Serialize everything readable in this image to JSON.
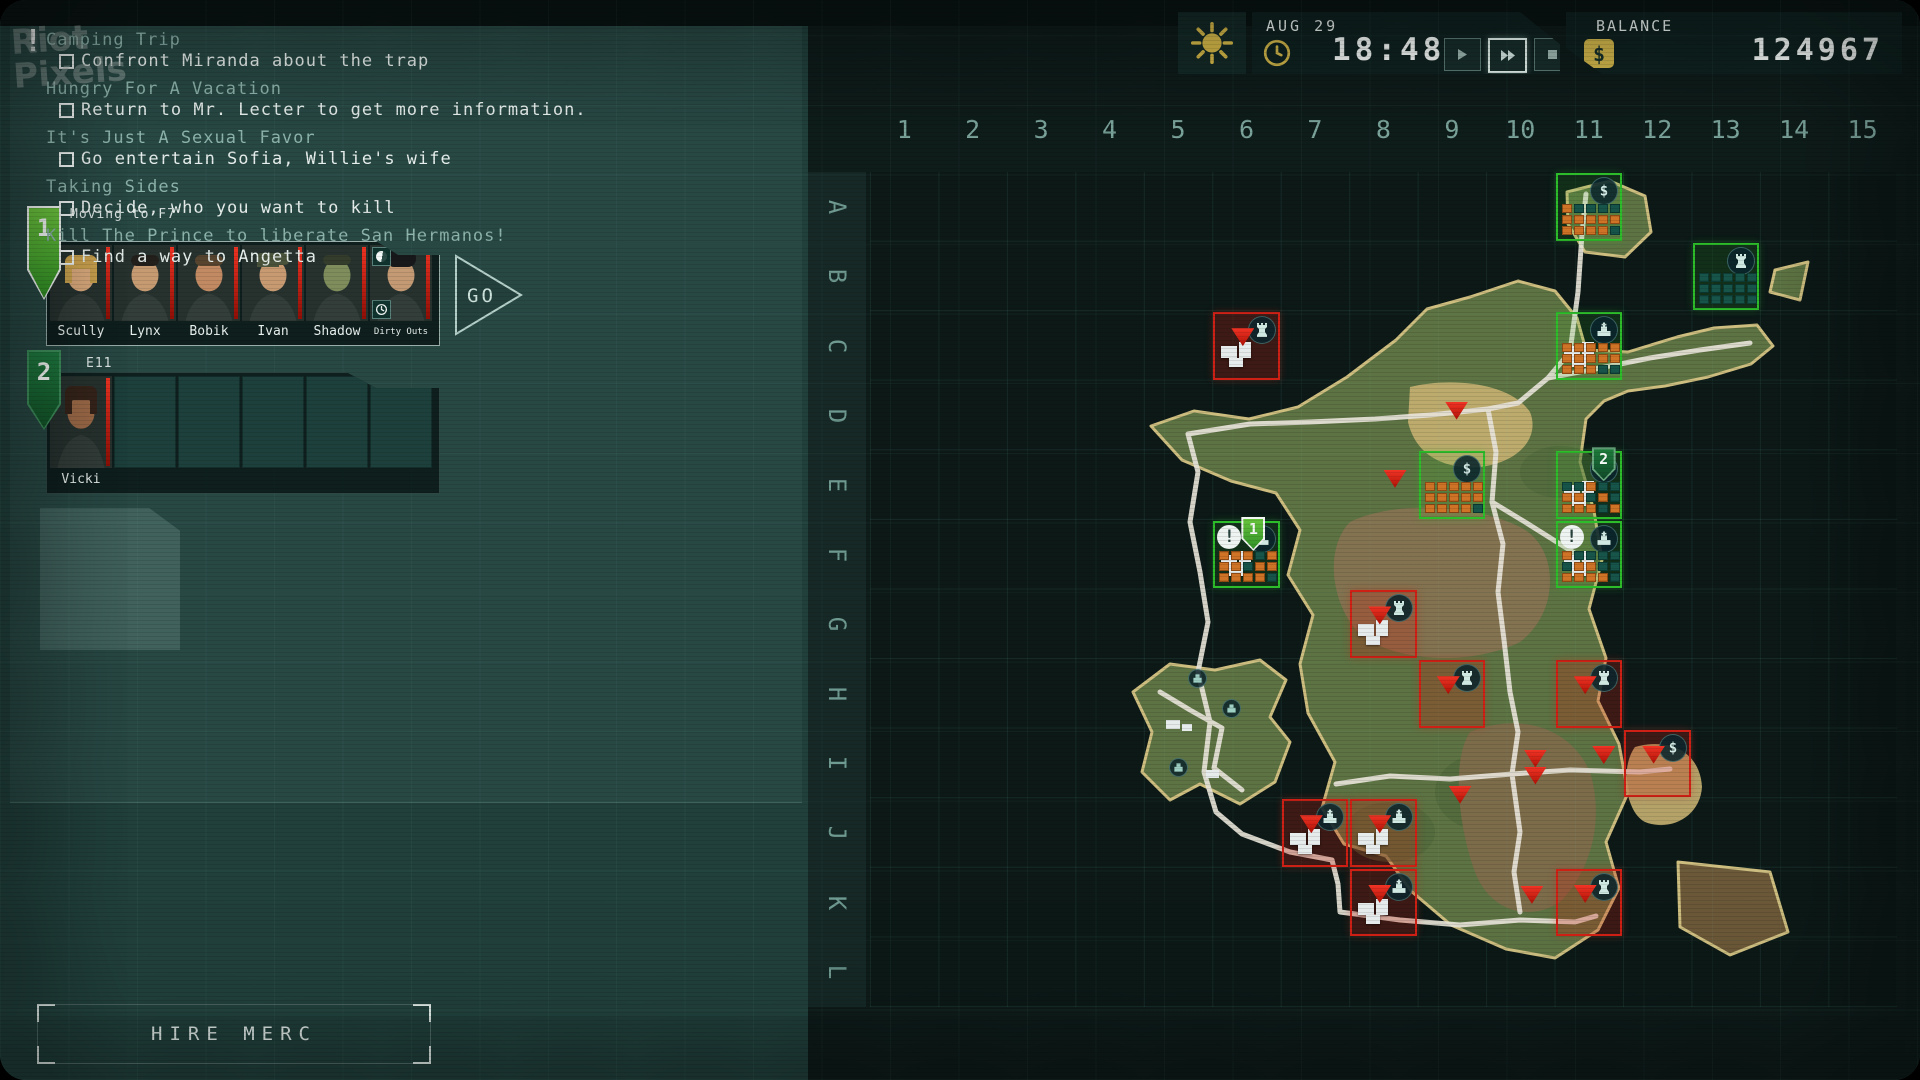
{
  "watermark": {
    "line1": "Riot",
    "line2": "Pixels"
  },
  "topbar": {
    "date": "AUG 29",
    "time": "18:48",
    "balance_label": "BALANCE",
    "balance": "124967",
    "controls": [
      {
        "name": "play",
        "active": false
      },
      {
        "name": "fast-forward",
        "active": true
      },
      {
        "name": "stop",
        "active": false
      }
    ]
  },
  "quests": [
    {
      "title": "Camping Trip",
      "task": "Confront Miranda about the trap",
      "alert": true
    },
    {
      "title": "Hungry For A Vacation",
      "task": "Return to Mr. Lecter to get more information."
    },
    {
      "title": "It's Just A Sexual Favor",
      "task": "Go entertain Sofia, Willie's wife"
    },
    {
      "title": "Taking Sides",
      "task": "Decide, who you want to kill"
    },
    {
      "title": "Kill The Prince to liberate San Hermanos!",
      "task": "Find a way to Angetta"
    }
  ],
  "squads": [
    {
      "number": "1",
      "status": "Moving to F7",
      "go_label": "GO",
      "mercs": [
        {
          "name": "Scully",
          "skin": "#d9a97c",
          "hair": "#c8a04e",
          "style": "long"
        },
        {
          "name": "Lynx",
          "skin": "#c79b72",
          "hair": "#23201c",
          "style": "short"
        },
        {
          "name": "Bobik",
          "skin": "#c28a63",
          "hair": "#57442f",
          "style": "short"
        },
        {
          "name": "Ivan",
          "skin": "#c79a72",
          "hair": "#49523a",
          "style": "cap"
        },
        {
          "name": "Shadow",
          "skin": "#7e8d5b",
          "hair": "#343c2c",
          "style": "camo"
        },
        {
          "name": "Dirty Outs",
          "skin": "#c39a74",
          "hair": "#17181a",
          "style": "beanie",
          "icons": [
            "moon",
            "clock"
          ]
        }
      ]
    },
    {
      "number": "2",
      "status": "E11",
      "mercs": [
        {
          "name": "Vicki",
          "skin": "#9c6a48",
          "hair": "#35241a",
          "style": "long"
        }
      ],
      "empty_slots": 5
    }
  ],
  "hire_label": "HIRE MERC",
  "map": {
    "columns": [
      "1",
      "2",
      "3",
      "4",
      "5",
      "6",
      "7",
      "8",
      "9",
      "10",
      "11",
      "12",
      "13",
      "14",
      "15"
    ],
    "rows": [
      "A",
      "B",
      "C",
      "D",
      "E",
      "F",
      "G",
      "H",
      "I",
      "J",
      "K",
      "L"
    ],
    "sectors": [
      {
        "cell": "A11",
        "side": "player",
        "icon": "dollar",
        "militia": [
          1,
          0,
          0,
          0,
          0,
          1,
          1,
          1,
          1,
          1,
          1,
          1,
          1,
          1,
          0
        ]
      },
      {
        "cell": "B13",
        "side": "player",
        "icon": "tower",
        "militia": [
          0,
          0,
          0,
          0,
          0,
          0,
          0,
          0,
          0,
          0,
          0,
          0,
          0,
          0,
          0
        ]
      },
      {
        "cell": "C11",
        "side": "player",
        "icon": "church",
        "town": true,
        "militia": [
          1,
          1,
          1,
          1,
          1,
          1,
          1,
          1,
          1,
          1,
          1,
          1,
          1,
          0,
          0
        ]
      },
      {
        "cell": "C6",
        "side": "enemy",
        "icon": "tower",
        "town": true,
        "triangle": true
      },
      {
        "cell": "E9",
        "side": "player",
        "icon": "dollar",
        "militia": [
          1,
          1,
          1,
          1,
          1,
          1,
          1,
          1,
          1,
          1,
          1,
          1,
          1,
          1,
          0
        ]
      },
      {
        "cell": "E11",
        "side": "player",
        "icon": "church",
        "town": true,
        "pin": "2",
        "militia": [
          0,
          0,
          1,
          0,
          0,
          1,
          1,
          0,
          1,
          0,
          1,
          1,
          1,
          0,
          1
        ]
      },
      {
        "cell": "F6",
        "side": "player",
        "icon": "church",
        "town": true,
        "pin": "1",
        "alert": true,
        "militia": [
          1,
          1,
          1,
          0,
          1,
          1,
          1,
          0,
          1,
          1,
          1,
          1,
          1,
          1,
          0
        ]
      },
      {
        "cell": "F11",
        "side": "player",
        "icon": "church",
        "town": true,
        "alert": true,
        "militia": [
          1,
          0,
          0,
          0,
          0,
          0,
          1,
          1,
          0,
          0,
          1,
          1,
          1,
          1,
          0
        ]
      },
      {
        "cell": "G8",
        "side": "enemy",
        "icon": "tower",
        "town": true,
        "triangle": true
      },
      {
        "cell": "H9",
        "side": "enemy",
        "icon": "tower",
        "triangle": true
      },
      {
        "cell": "H11",
        "side": "enemy",
        "icon": "tower",
        "triangle": true
      },
      {
        "cell": "I12",
        "side": "enemy",
        "icon": "dollar",
        "triangle": true
      },
      {
        "cell": "J7",
        "side": "enemy",
        "icon": "church",
        "town": true,
        "triangle": true
      },
      {
        "cell": "J8",
        "side": "enemy",
        "icon": "church",
        "town": true,
        "triangle": true
      },
      {
        "cell": "K8",
        "side": "enemy",
        "icon": "church",
        "town": true,
        "triangle": true
      },
      {
        "cell": "K11",
        "side": "enemy",
        "icon": "tower",
        "triangle": true
      }
    ],
    "units": [
      {
        "cell": "D9",
        "fx": 0.4,
        "fy": 0.3,
        "count": 1
      },
      {
        "cell": "E8",
        "fx": 0.5,
        "fy": 0.28,
        "count": 1
      },
      {
        "cell": "I9",
        "fx": 0.45,
        "fy": 0.82,
        "count": 1
      },
      {
        "cell": "I10",
        "fx": 0.55,
        "fy": 0.3,
        "count": 2
      },
      {
        "cell": "I11",
        "fx": 0.55,
        "fy": 0.25,
        "count": 1
      },
      {
        "cell": "K10",
        "fx": 0.5,
        "fy": 0.26,
        "count": 1
      }
    ],
    "deco_icons": [
      {
        "x": 318,
        "y": 497,
        "type": "building"
      },
      {
        "x": 352,
        "y": 527,
        "type": "building"
      },
      {
        "x": 299,
        "y": 586,
        "type": "building"
      }
    ]
  },
  "colors": {
    "player_green": "#2dbd2b",
    "enemy_red": "#cf2015",
    "militia_filled": "#cf7326",
    "militia_empty": "#17544a",
    "accent_yellow": "#d3b84c"
  }
}
